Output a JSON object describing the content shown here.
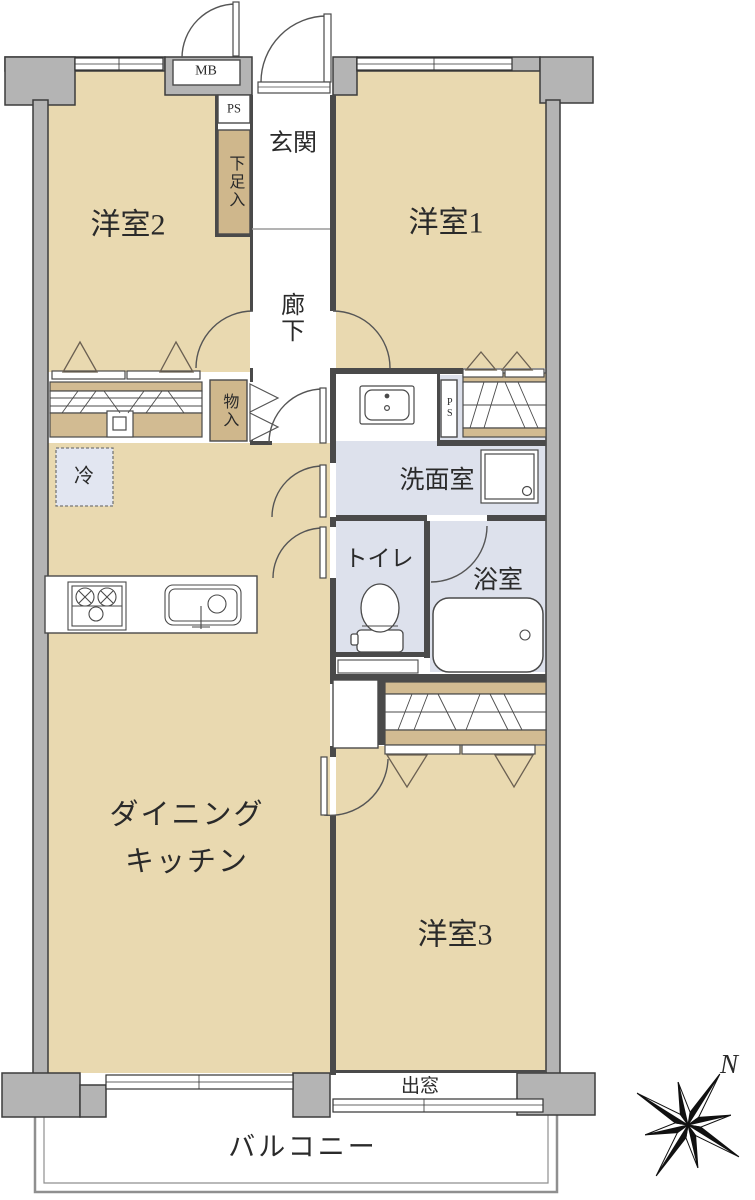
{
  "rooms": {
    "western1": "洋室1",
    "western2": "洋室2",
    "western3": "洋室3",
    "entry": "玄関",
    "corridor": "廊下",
    "dining_kitchen_line1": "ダイニング",
    "dining_kitchen_line2": "キッチン",
    "washroom": "洗面室",
    "toilet": "トイレ",
    "bathroom": "浴室",
    "balcony": "バルコニー",
    "bay_window": "出窓"
  },
  "storage": {
    "shoe_cabinet": "下足入",
    "hall_closet": "物入",
    "refrigerator": "冷"
  },
  "utility": {
    "meter_box": "MB",
    "pipe_space_top": "PS",
    "pipe_space_side": "PS"
  },
  "compass": {
    "north": "N"
  },
  "colors": {
    "room_fill": "#e9d9b0",
    "closet_fill": "#d2bb92",
    "wet_area_fill": "#dde1ec",
    "refrigerator_fill": "#e2e6f1",
    "wall_fill": "#b4b4b4",
    "line": "#3c3c3c"
  }
}
